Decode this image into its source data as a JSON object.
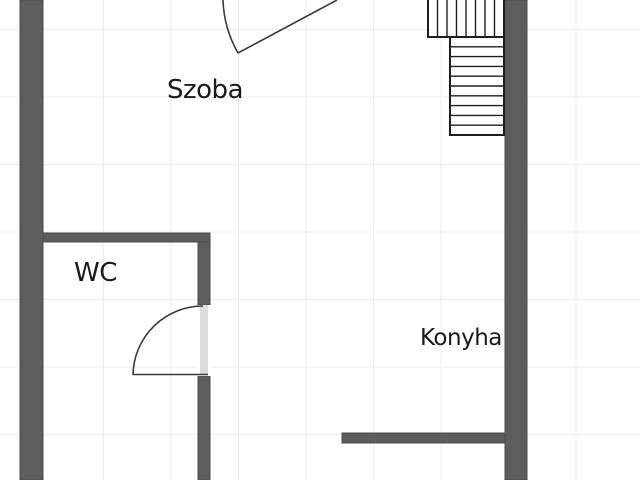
{
  "canvas": {
    "width": 640,
    "height": 480
  },
  "colors": {
    "background": "#ffffff",
    "wall_fill": "#5d5d5d",
    "wall_edge": "#4a4a4a",
    "stair_fill": "#ffffff",
    "stair_stroke": "#1e1e1e",
    "door_line": "#3a3a3a",
    "door_panel": "#dcdcdc",
    "grid_line": "#ededed",
    "label_text": "#1a1a1a"
  },
  "grid": {
    "spacing": 67.5,
    "offset_x": 36,
    "offset_y": 29.5
  },
  "rooms": [
    {
      "name": "szoba",
      "label": "Szoba",
      "left": 167,
      "top": 76,
      "font_size": 26
    },
    {
      "name": "wc",
      "label": "WC",
      "left": 74,
      "top": 259,
      "font_size": 26
    },
    {
      "name": "konyha",
      "label": "Konyha",
      "left": 420,
      "top": 326,
      "font_size": 23
    }
  ],
  "walls": [
    {
      "name": "wall-left",
      "x": 20,
      "y": 0,
      "w": 23,
      "h": 480
    },
    {
      "name": "wall-right",
      "x": 505,
      "y": 0,
      "w": 22,
      "h": 480
    },
    {
      "name": "wall-wc-top",
      "x": 43,
      "y": 233,
      "w": 167,
      "h": 9
    },
    {
      "name": "wall-wc-right-upper",
      "x": 198,
      "y": 242,
      "w": 12,
      "h": 63
    },
    {
      "name": "wall-wc-right-lower",
      "x": 198,
      "y": 376,
      "w": 12,
      "h": 104
    },
    {
      "name": "wall-kitchen",
      "x": 342,
      "y": 433,
      "w": 163,
      "h": 10
    }
  ],
  "stairs": [
    {
      "name": "staircase-upper-run",
      "x": 428,
      "y": -3,
      "w": 76,
      "h": 40,
      "treads": 8,
      "tread_dir": "vertical"
    },
    {
      "name": "staircase-lower-run",
      "x": 450,
      "y": 37,
      "w": 54,
      "h": 98,
      "treads": 10,
      "tread_dir": "horizontal"
    }
  ],
  "doors": [
    {
      "name": "door-szoba",
      "arc": "M 223 0 A 114 114 0 0 0 238 53",
      "leaf": {
        "x1": 238,
        "y1": 53,
        "x2": 337,
        "y2": 0
      }
    },
    {
      "name": "door-wc",
      "opening": {
        "x": 197,
        "y": 305,
        "w": 14,
        "h": 71
      },
      "panel": {
        "x": 200,
        "y": 305,
        "w": 8,
        "h": 70
      },
      "arc": "M 203 306 A 70 70 0 0 0 133 375",
      "leaf": {
        "x1": 133,
        "y1": 374.5,
        "x2": 208,
        "y2": 374.5
      }
    }
  ]
}
